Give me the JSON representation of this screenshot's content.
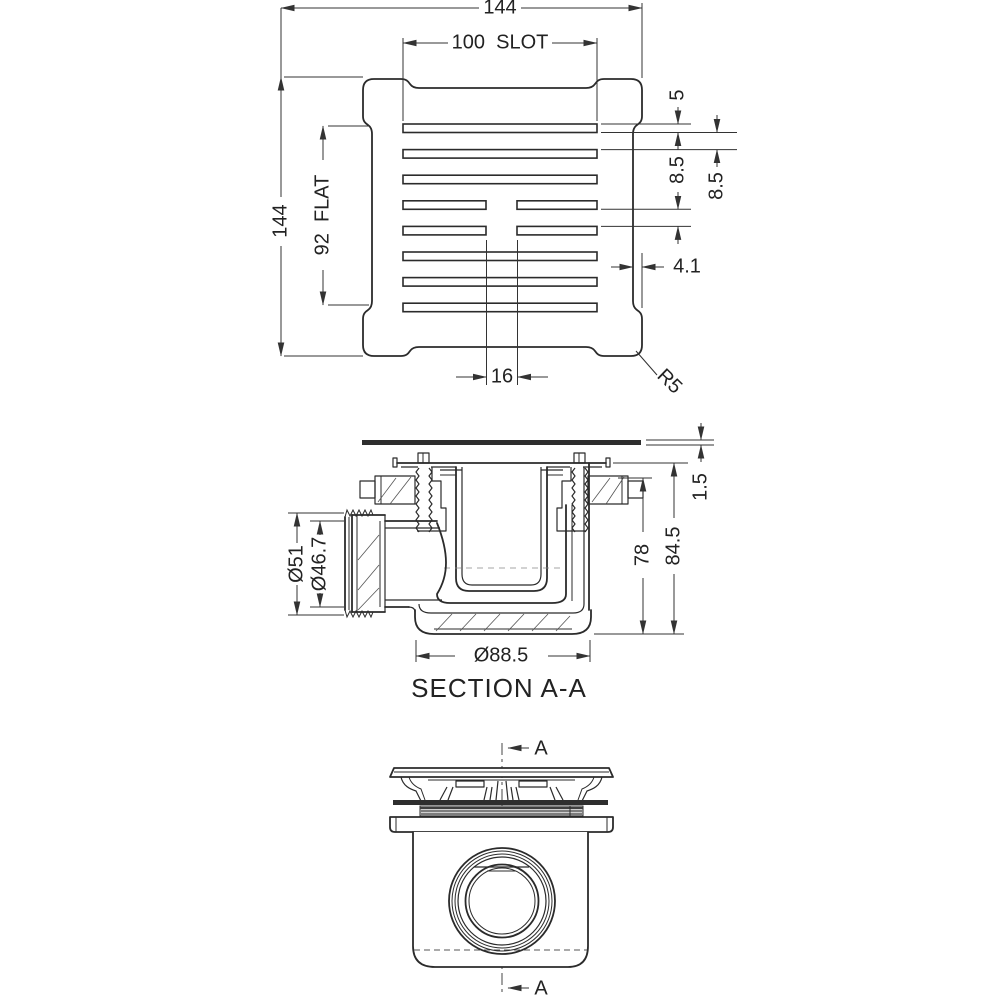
{
  "drawing": {
    "top_view": {
      "dim_overall_width": "144",
      "dim_slot_length": "100  SLOT",
      "dim_overall_height": "144",
      "dim_flat": "92  FLAT",
      "dim_slot_width": "5",
      "dim_rib_a": "8.5",
      "dim_rib_b": "8.5",
      "dim_edge_step": "4.1",
      "dim_center_gap": "16",
      "dim_corner_radius": "R5"
    },
    "section_view": {
      "title": "SECTION A-A",
      "dim_plate_thickness": "1.5",
      "dim_inner_height": "78",
      "dim_overall_height": "84.5",
      "dim_outlet_outer_diameter": "Ø51",
      "dim_outlet_inner_diameter": "Ø46.7",
      "dim_base_diameter": "Ø88.5"
    },
    "front_view": {
      "section_label_top": "A",
      "section_label_bottom": "A"
    }
  }
}
